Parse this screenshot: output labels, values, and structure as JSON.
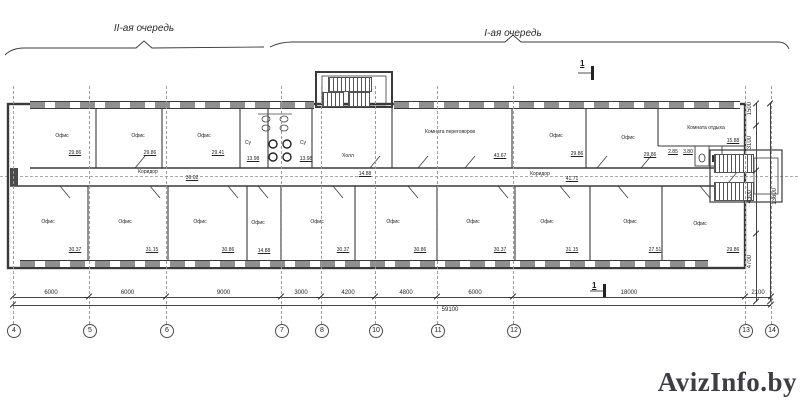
{
  "phases": {
    "left": "II-ая очередь",
    "right": "I-ая очередь"
  },
  "section_mark": {
    "label": "1"
  },
  "watermark": "AvizInfo.by",
  "grid": {
    "bubbles": [
      {
        "n": "4",
        "x": 13
      },
      {
        "n": "5",
        "x": 89
      },
      {
        "n": "6",
        "x": 166
      },
      {
        "n": "7",
        "x": 281
      },
      {
        "n": "8",
        "x": 321
      },
      {
        "n": "10",
        "x": 375
      },
      {
        "n": "11",
        "x": 437
      },
      {
        "n": "12",
        "x": 513
      },
      {
        "n": "13",
        "x": 745
      },
      {
        "n": "14",
        "x": 771
      }
    ]
  },
  "dims": {
    "bottom": [
      {
        "v": "6000",
        "x1": 13,
        "x2": 89
      },
      {
        "v": "6000",
        "x1": 89,
        "x2": 166
      },
      {
        "v": "9000",
        "x1": 166,
        "x2": 281
      },
      {
        "v": "3000",
        "x1": 281,
        "x2": 321
      },
      {
        "v": "4200",
        "x1": 321,
        "x2": 375
      },
      {
        "v": "4800",
        "x1": 375,
        "x2": 437
      },
      {
        "v": "6000",
        "x1": 437,
        "x2": 513
      },
      {
        "v": "18000",
        "x1": 513,
        "x2": 745
      },
      {
        "v": "2100",
        "x1": 745,
        "x2": 771
      }
    ],
    "bottom_total": "59100",
    "right": [
      {
        "v": "1500",
        "y1": 103,
        "y2": 125
      },
      {
        "v": "3100",
        "y1": 125,
        "y2": 170
      },
      {
        "v": "4300",
        "y1": 170,
        "y2": 233
      },
      {
        "v": "4700",
        "y1": 233,
        "y2": 301
      }
    ],
    "right_total": "13600"
  },
  "rooms": [
    {
      "label": "Офис",
      "lx": 62,
      "ly": 133,
      "area": "29.86",
      "ax": 75,
      "ay": 150
    },
    {
      "label": "Офис",
      "lx": 138,
      "ly": 133,
      "area": "29.86",
      "ax": 150,
      "ay": 150
    },
    {
      "label": "Офис",
      "lx": 204,
      "ly": 133,
      "area": "29.41",
      "ax": 218,
      "ay": 150
    },
    {
      "label": "Су",
      "lx": 248,
      "ly": 140,
      "area": "13.98",
      "ax": 253,
      "ay": 156
    },
    {
      "label": "Су",
      "lx": 303,
      "ly": 140,
      "area": "13.98",
      "ax": 306,
      "ay": 156
    },
    {
      "label": "Холл",
      "lx": 348,
      "ly": 153,
      "area": "14.88",
      "ax": 365,
      "ay": 171
    },
    {
      "label": "Комната переговоров",
      "lx": 450,
      "ly": 129,
      "area": "43.67",
      "ax": 500,
      "ay": 153
    },
    {
      "label": "Офис",
      "lx": 556,
      "ly": 133,
      "area": "29.86",
      "ax": 577,
      "ay": 151
    },
    {
      "label": "Офис",
      "lx": 628,
      "ly": 135,
      "area": "29.86",
      "ax": 650,
      "ay": 152
    },
    {
      "label": "Комната отдыха",
      "lx": 706,
      "ly": 125,
      "area": "15.88",
      "ax": 733,
      "ay": 138
    },
    {
      "label": "",
      "lx": 0,
      "ly": 0,
      "area": "2.85",
      "ax": 673,
      "ay": 149
    },
    {
      "label": "",
      "lx": 0,
      "ly": 0,
      "area": "3.80",
      "ax": 688,
      "ay": 149
    },
    {
      "label": "Коридор",
      "lx": 148,
      "ly": 169,
      "area": "36.02",
      "ax": 192,
      "ay": 175
    },
    {
      "label": "Коридор",
      "lx": 540,
      "ly": 171,
      "area": "41.71",
      "ax": 572,
      "ay": 176
    },
    {
      "label": "Офис",
      "lx": 48,
      "ly": 219,
      "area": "30.37",
      "ax": 75,
      "ay": 247
    },
    {
      "label": "Офис",
      "lx": 125,
      "ly": 219,
      "area": "31.15",
      "ax": 152,
      "ay": 247
    },
    {
      "label": "Офис",
      "lx": 200,
      "ly": 219,
      "area": "30.86",
      "ax": 228,
      "ay": 247
    },
    {
      "label": "Офис",
      "lx": 258,
      "ly": 220,
      "area": "14.88",
      "ax": 264,
      "ay": 248
    },
    {
      "label": "Офис",
      "lx": 317,
      "ly": 219,
      "area": "30.37",
      "ax": 343,
      "ay": 247
    },
    {
      "label": "Офис",
      "lx": 393,
      "ly": 219,
      "area": "30.86",
      "ax": 420,
      "ay": 247
    },
    {
      "label": "Офис",
      "lx": 473,
      "ly": 219,
      "area": "30.37",
      "ax": 500,
      "ay": 247
    },
    {
      "label": "Офис",
      "lx": 547,
      "ly": 219,
      "area": "31.15",
      "ax": 572,
      "ay": 247
    },
    {
      "label": "Офис",
      "lx": 630,
      "ly": 219,
      "area": "27.51",
      "ax": 655,
      "ay": 247
    },
    {
      "label": "Офис",
      "lx": 700,
      "ly": 221,
      "area": "29.86",
      "ax": 733,
      "ay": 247
    }
  ]
}
